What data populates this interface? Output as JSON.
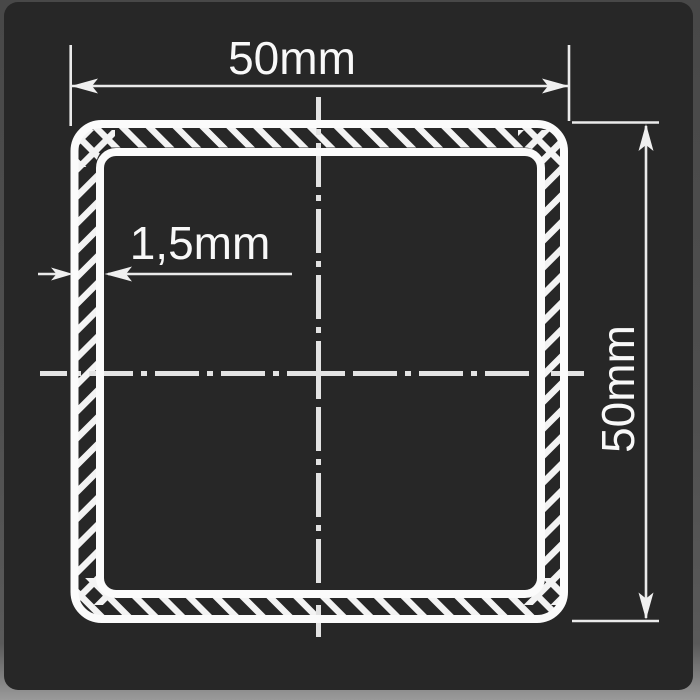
{
  "drawing": {
    "subject": "square-hollow-tube-cross-section",
    "dimensions": {
      "width_label": "50mm",
      "height_label": "50mm",
      "wall_thickness_label": "1,5mm"
    }
  },
  "colors": {
    "page_background": "#4f4f4f",
    "card_background": "#272727",
    "contour": "#fbfbfb",
    "hatch": "#f3f3f3",
    "centerline": "#e3e3e3",
    "dimension_line": "#eaeaea",
    "arrow_fill": "#f0f0f0",
    "text": "#f8f8f8"
  }
}
